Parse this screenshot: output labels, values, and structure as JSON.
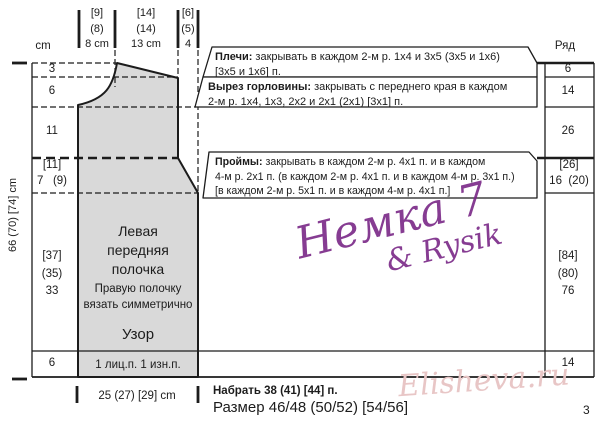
{
  "header": {
    "cm": "cm",
    "row": "Ряд"
  },
  "top_measurements": [
    "[9]\n(8)\n8 cm",
    "[14]\n(14)\n13 cm",
    "[6]\n(5)\n4"
  ],
  "left_scale": {
    "rows": [
      "3",
      "6",
      "11",
      "[11]\n7   (9)",
      "[37]\n(35)\n33",
      "6"
    ],
    "total": "66 (70) [74] cm"
  },
  "right_scale": {
    "rows": [
      "6",
      "14",
      "26",
      "[26]\n16  (20)",
      "[84]\n(80)\n76",
      "14"
    ]
  },
  "callouts": {
    "shoulders": {
      "label": "Плечи:",
      "text": "закрывать в каждом 2-м р. 1x4 и 3x5 (3x5 и 1x6)",
      "text2": "[3x5 и 1x6] п."
    },
    "neckline": {
      "label": "Вырез горловины:",
      "text": "закрывать с переднего края в каждом",
      "text2": "2-м р. 1x4, 1x3, 2x2 и 2x1 (2x1) [3x1] п."
    },
    "armholes": {
      "label": "Проймы:",
      "text": "закрывать в каждом 2-м р. 4x1 п. и в каждом",
      "text2": "4-м р. 2x1 п. (в каждом 2-м р. 4x1 п. и в каждом 4-м р. 3x1 п.)",
      "text3": "[в каждом 2-м р. 5x1 п. и в каждом 4-м р. 4x1 п.]"
    }
  },
  "panel": {
    "title": "Левая\nпередняя\nполочка",
    "note": "Правую полочку\nвязать симметрично",
    "pattern": "Узор",
    "rib": "1 лиц.п. 1 изн.п."
  },
  "bottom": {
    "width": "25 (27) [29] cm",
    "cast_on": "Набрать 38 (41) [44] п.",
    "size": "Размер 46/48 (50/52) [54/56]",
    "page": "3"
  },
  "watermarks": {
    "name1": "Немка 7",
    "name2": "& Rysik",
    "site": "Elisheva.ru"
  },
  "colors": {
    "garment_fill": "#d9d9d9",
    "line": "#1c1c1c",
    "watermark_purple": "#7a2887",
    "watermark_pink": "#e8c6c6"
  }
}
